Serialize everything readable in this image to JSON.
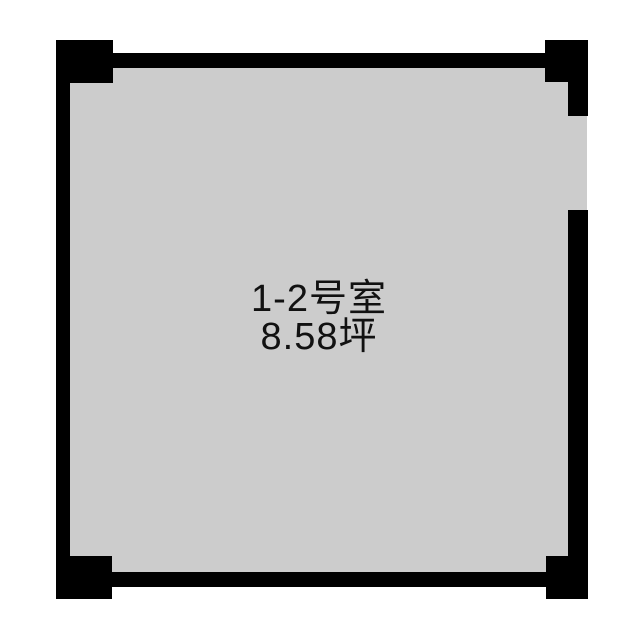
{
  "floorplan": {
    "title": "Room floor plan",
    "room": {
      "name": "1-2号室",
      "area": "8.58坪"
    },
    "features": {
      "door_opening": "right wall, upper section",
      "corner_pillars": 4
    },
    "colors": {
      "wall": "#000000",
      "floor": "#cccccc",
      "background": "#ffffff",
      "text": "#111111"
    }
  }
}
